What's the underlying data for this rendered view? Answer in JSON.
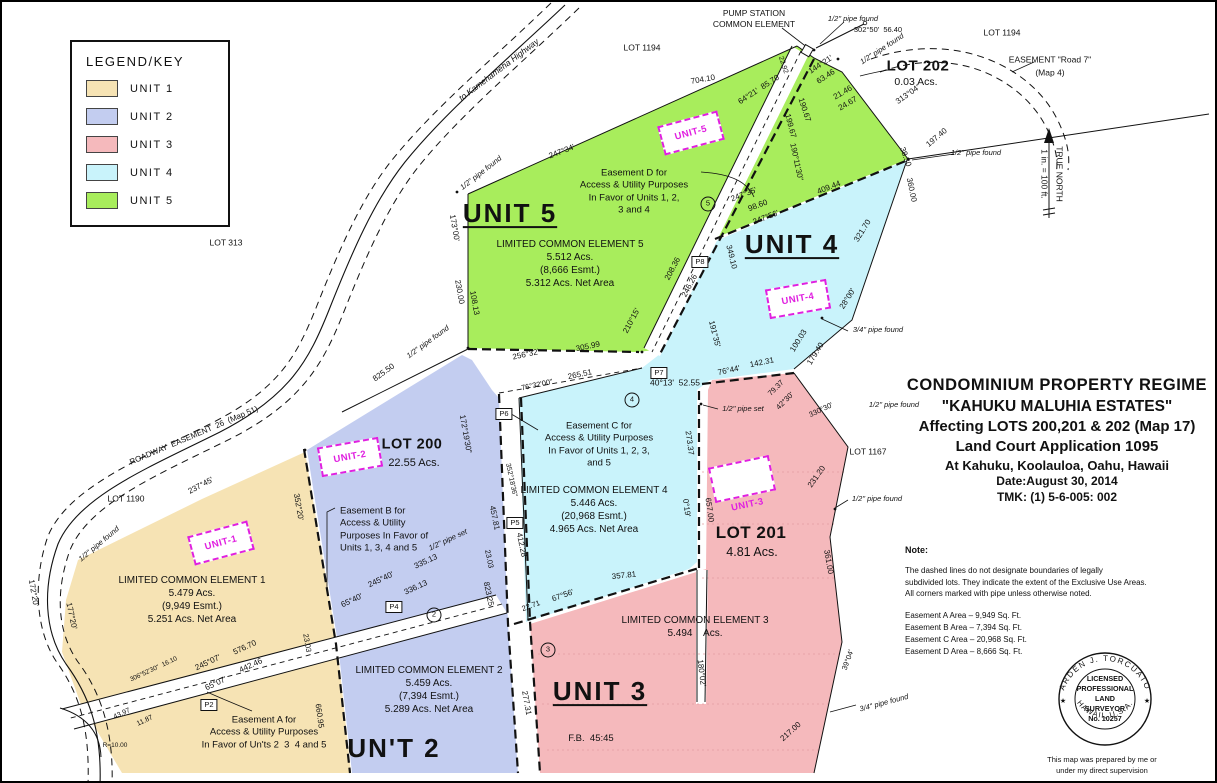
{
  "colors": {
    "unit1": "#F6E3B4",
    "unit2": "#C3CDF0",
    "unit3": "#F5B9BC",
    "unit4": "#C9F3FB",
    "unit5": "#A8ED5C",
    "magenta": "#E020E0",
    "line": "#111111",
    "faint_pink_line": "#E39CA0"
  },
  "legend": {
    "title": "LEGEND/KEY",
    "items": [
      {
        "name": "legend-item-unit1",
        "text": "UNIT 1",
        "color": "#F6E3B4"
      },
      {
        "name": "legend-item-unit2",
        "text": "UNIT 2",
        "color": "#C3CDF0"
      },
      {
        "name": "legend-item-unit3",
        "text": "UNIT 3",
        "color": "#F5B9BC"
      },
      {
        "name": "legend-item-unit4",
        "text": "UNIT 4",
        "color": "#C9F3FB"
      },
      {
        "name": "legend-item-unit5",
        "text": "UNIT 5",
        "color": "#A8ED5C"
      }
    ]
  },
  "title_block": {
    "line1": "CONDOMINIUM  PROPERTY  REGIME",
    "line2": "\"KAHUKU MALUHIA ESTATES\"",
    "line3": "Affecting LOTS 200,201 & 202 (Map 17)",
    "line4": "Land Court Application 1095",
    "line5": "At Kahuku, Koolauloa, Oahu, Hawaii",
    "line6": "Date:August 30, 2014",
    "line7": "TMK: (1) 5-6-005: 002"
  },
  "note": {
    "heading": "Note:",
    "body": "The dashed lines do not designate boundaries of legally\nsubdivided lots. They indicate the extent of the Exclusive Use Areas.\nAll corners marked with pipe unless otherwise noted.",
    "easements": "Easement A Area – 9,949 Sq. Ft.\nEasement B Area – 7,394 Sq. Ft.\nEasement C Area – 20,968 Sq. Ft.\nEasement D Area – 8,666 Sq. Ft."
  },
  "stamp": {
    "arc_top": "ARDEN  J.  TORCUATO",
    "arc_bottom": "HAWAII, U.S.A.",
    "star": "★",
    "lines": [
      {
        "text": "LICENSED"
      },
      {
        "text": "PROFESSIONAL"
      },
      {
        "text": "LAND"
      },
      {
        "text": "SURVEYOR"
      },
      {
        "text": "No. 10257"
      }
    ],
    "caption": "This map was prepared by me or\nunder my direct supervision"
  },
  "unit_markers": [
    {
      "name": "unit-1-marker",
      "text": "UNIT-1",
      "x": 219,
      "y": 541,
      "rot": -15
    },
    {
      "name": "unit-2-marker",
      "text": "UNIT-2",
      "x": 348,
      "y": 455,
      "rot": -10
    },
    {
      "name": "unit-3-marker",
      "text": "UNIT-3",
      "x": 740,
      "y": 477,
      "rot": -12,
      "cls": "below"
    },
    {
      "name": "unit-4-marker",
      "text": "UNIT-4",
      "x": 796,
      "y": 297,
      "rot": -10
    },
    {
      "name": "unit-5-marker",
      "text": "UNIT-5",
      "x": 689,
      "y": 131,
      "rot": -15
    }
  ],
  "point_markers": [
    {
      "name": "point-p2",
      "text": "P2",
      "x": 207,
      "y": 703
    },
    {
      "name": "point-p4",
      "text": "P4",
      "x": 392,
      "y": 605
    },
    {
      "name": "point-p5",
      "text": "P5",
      "x": 513,
      "y": 521
    },
    {
      "name": "point-p6",
      "text": "P6",
      "x": 502,
      "y": 412
    },
    {
      "name": "point-p7",
      "text": "P7",
      "x": 657,
      "y": 371
    },
    {
      "name": "point-p8",
      "text": "P8",
      "x": 698,
      "y": 260
    }
  ],
  "circle_markers": [
    {
      "name": "circle-2",
      "text": "2",
      "x": 432,
      "y": 613
    },
    {
      "name": "circle-3",
      "text": "3",
      "x": 546,
      "y": 648
    },
    {
      "name": "circle-4",
      "text": "4",
      "x": 630,
      "y": 398
    },
    {
      "name": "circle-5",
      "text": "5",
      "x": 706,
      "y": 202
    }
  ],
  "labels": [
    {
      "name": "pump-station-label",
      "text": "PUMP STATION\nCOMMON ELEMENT",
      "x": 752,
      "y": 17,
      "fs": 8.5
    },
    {
      "name": "pipe-found-label",
      "text": "1/2\" pipe found",
      "x": 851,
      "y": 17,
      "fs": 7.5,
      "cls": "it"
    },
    {
      "name": "bearing-label",
      "text": "302°50'  56.40",
      "x": 876,
      "y": 28,
      "fs": 7.5
    },
    {
      "name": "pipe-found-label",
      "text": "1/2\" pipe found",
      "x": 880,
      "y": 47,
      "fs": 7.5,
      "rot": -33,
      "cls": "it"
    },
    {
      "name": "lot-202-label",
      "text": "LOT 202",
      "x": 916,
      "y": 64,
      "fs": 15,
      "cls": "semibold"
    },
    {
      "name": "lot-202-area",
      "text": "0.03 Acs.",
      "x": 914,
      "y": 81,
      "fs": 10.5
    },
    {
      "name": "lot-1194-label",
      "text": "LOT 1194",
      "x": 640,
      "y": 46,
      "fs": 8.5
    },
    {
      "name": "lot-1194-label",
      "text": "LOT 1194",
      "x": 1000,
      "y": 31,
      "fs": 8.5
    },
    {
      "name": "easement-road7-label",
      "text": "EASEMENT \"Road 7\"",
      "x": 1048,
      "y": 58,
      "fs": 8.5
    },
    {
      "name": "easement-road7-map",
      "text": "(Map 4)",
      "x": 1048,
      "y": 71,
      "fs": 8.5
    },
    {
      "name": "meas-label",
      "text": "704.10",
      "x": 701,
      "y": 78,
      "rot": -10
    },
    {
      "name": "meas-label",
      "text": "64°21'  85.70",
      "x": 757,
      "y": 88,
      "rot": -33
    },
    {
      "name": "meas-label",
      "text": "144°21'",
      "x": 819,
      "y": 63,
      "rot": -33
    },
    {
      "name": "meas-label",
      "text": "63.46",
      "x": 824,
      "y": 75,
      "rot": -33
    },
    {
      "name": "meas-label",
      "text": "21.46",
      "x": 841,
      "y": 91,
      "rot": -30
    },
    {
      "name": "meas-label",
      "text": "24.67",
      "x": 846,
      "y": 102,
      "rot": -30
    },
    {
      "name": "meas-label",
      "text": "22.92",
      "x": 781,
      "y": 63,
      "rot": 72,
      "fs": 7
    },
    {
      "name": "meas-label",
      "text": "190.67",
      "x": 802,
      "y": 108,
      "rot": 72
    },
    {
      "name": "meas-label",
      "text": "199.67",
      "x": 788,
      "y": 124,
      "rot": 75
    },
    {
      "name": "meas-label",
      "text": "190°11'30\"",
      "x": 794,
      "y": 160,
      "rot": 78
    },
    {
      "name": "meas-label",
      "text": "313°04'",
      "x": 906,
      "y": 93,
      "rot": -35
    },
    {
      "name": "meas-label",
      "text": "197.40",
      "x": 935,
      "y": 136,
      "rot": -40
    },
    {
      "name": "meas-label",
      "text": "38.30",
      "x": 903,
      "y": 155,
      "rot": 70
    },
    {
      "name": "meas-label",
      "text": "360.00",
      "x": 909,
      "y": 188,
      "rot": 78
    },
    {
      "name": "pipe-found-label",
      "text": "1/2\" pipe found",
      "x": 974,
      "y": 151,
      "fs": 7.5,
      "cls": "it"
    },
    {
      "name": "road-kamehameha-label",
      "text": "to Kamehameha Highway",
      "x": 497,
      "y": 68,
      "fs": 8.5,
      "rot": -37,
      "cls": "it"
    },
    {
      "name": "meas-label",
      "text": "247°34'",
      "x": 560,
      "y": 150,
      "rot": -21
    },
    {
      "name": "pipe-found-label",
      "text": "1/2\" pipe found",
      "x": 479,
      "y": 171,
      "fs": 7.5,
      "rot": -38,
      "cls": "it"
    },
    {
      "name": "meas-label",
      "text": "173°00'",
      "x": 452,
      "y": 226,
      "rot": 80
    },
    {
      "name": "meas-label",
      "text": "230.00",
      "x": 457,
      "y": 290,
      "rot": 80
    },
    {
      "name": "meas-label",
      "text": "108.13",
      "x": 472,
      "y": 301,
      "rot": 80
    },
    {
      "name": "lot-313-label",
      "text": "LOT 313",
      "x": 224,
      "y": 241,
      "fs": 8.5
    },
    {
      "name": "unit5-title",
      "text": "UNIT 5",
      "x": 508,
      "y": 212,
      "fs": 26,
      "cls": "big underline"
    },
    {
      "name": "easement-d-note",
      "text": "Easement D for\nAccess & Utility Purposes\nIn Favor of Units 1, 2,\n3 and 4",
      "x": 632,
      "y": 190,
      "fs": 9.5
    },
    {
      "name": "lce5-note",
      "text": "LIMITED COMMON ELEMENT 5\n5.512 Acs.\n(8,666 Esmt.)\n5.312 Acs. Net Area",
      "x": 568,
      "y": 262,
      "fs": 10,
      "cls": "lce"
    },
    {
      "name": "meas-label",
      "text": "256°32'",
      "x": 524,
      "y": 353,
      "rot": -12
    },
    {
      "name": "meas-label",
      "text": "305.99",
      "x": 586,
      "y": 345,
      "rot": -12
    },
    {
      "name": "meas-label",
      "text": "76°32'00\"",
      "x": 535,
      "y": 383,
      "fs": 7.5,
      "rot": -12
    },
    {
      "name": "meas-label",
      "text": "265.51",
      "x": 578,
      "y": 373,
      "rot": -12
    },
    {
      "name": "meas-label",
      "text": "825.50",
      "x": 382,
      "y": 371,
      "rot": -36
    },
    {
      "name": "pipe-found-label",
      "text": "1/2\" pipe found",
      "x": 426,
      "y": 340,
      "fs": 7.5,
      "rot": -36,
      "cls": "it"
    },
    {
      "name": "meas-label",
      "text": "210°15'",
      "x": 630,
      "y": 319,
      "rot": -62
    },
    {
      "name": "meas-label",
      "text": "208.36",
      "x": 671,
      "y": 267,
      "rot": -62
    },
    {
      "name": "meas-label",
      "text": "246.26",
      "x": 688,
      "y": 284,
      "rot": -62
    },
    {
      "name": "meas-label",
      "text": "247°35'",
      "x": 742,
      "y": 193,
      "rot": -21
    },
    {
      "name": "meas-label",
      "text": "98.60",
      "x": 756,
      "y": 204,
      "rot": -21
    },
    {
      "name": "meas-label",
      "text": "247°56'",
      "x": 764,
      "y": 216,
      "rot": -21
    },
    {
      "name": "meas-label",
      "text": "409.44",
      "x": 827,
      "y": 186,
      "rot": -21
    },
    {
      "name": "meas-label",
      "text": "349.10",
      "x": 729,
      "y": 255,
      "rot": 76
    },
    {
      "name": "meas-label",
      "text": "321.70",
      "x": 861,
      "y": 229,
      "rot": -58
    },
    {
      "name": "unit4-title",
      "text": "UNIT 4",
      "x": 790,
      "y": 243,
      "fs": 26,
      "cls": "big underline"
    },
    {
      "name": "meas-label",
      "text": "28°00'",
      "x": 846,
      "y": 297,
      "rot": -58
    },
    {
      "name": "meas-label",
      "text": "191°35'",
      "x": 712,
      "y": 332,
      "rot": 76
    },
    {
      "name": "meas-label",
      "text": "100.03",
      "x": 797,
      "y": 339,
      "rot": -58
    },
    {
      "name": "meas-label",
      "text": "179.40",
      "x": 814,
      "y": 352,
      "rot": -58
    },
    {
      "name": "pipe-found-label",
      "text": "3/4\" pipe found",
      "x": 876,
      "y": 328,
      "fs": 7.5,
      "cls": "it"
    },
    {
      "name": "meas-label",
      "text": "142.31",
      "x": 760,
      "y": 361,
      "rot": -12
    },
    {
      "name": "meas-label",
      "text": "76°44'",
      "x": 727,
      "y": 369,
      "rot": -12
    },
    {
      "name": "meas-label",
      "text": "40°13'  52.55",
      "x": 673,
      "y": 381,
      "fs": 8.5
    },
    {
      "name": "meas-label",
      "text": "79.37",
      "x": 774,
      "y": 386,
      "fs": 7.5,
      "rot": -45
    },
    {
      "name": "meas-label",
      "text": "42°30'",
      "x": 783,
      "y": 399,
      "fs": 7.5,
      "rot": -45
    },
    {
      "name": "meas-label",
      "text": "330°30'",
      "x": 819,
      "y": 408,
      "fs": 7.5,
      "rot": -25
    },
    {
      "name": "pipe-set-label",
      "text": "1/2\" pipe set",
      "x": 741,
      "y": 407,
      "fs": 7.5,
      "cls": "it"
    },
    {
      "name": "pipe-found-label",
      "text": "1/2\" pipe found",
      "x": 892,
      "y": 403,
      "fs": 7.5,
      "cls": "it"
    },
    {
      "name": "easement-c-note",
      "text": "Easement C for\nAccess & Utility Purposes\nIn Favor of Units 1, 2, 3,\nand 5",
      "x": 597,
      "y": 443,
      "fs": 9.5
    },
    {
      "name": "lce4-note",
      "text": "LIMITED COMMON ELEMENT 4\n5.446 Acs.\n(20,968 Esmt.)\n4.965 Acs. Net Area",
      "x": 592,
      "y": 508,
      "fs": 10,
      "cls": "lce"
    },
    {
      "name": "meas-label",
      "text": "273.37",
      "x": 687,
      "y": 441,
      "rot": 82
    },
    {
      "name": "meas-label",
      "text": "0°19'",
      "x": 684,
      "y": 506,
      "rot": 82
    },
    {
      "name": "meas-label",
      "text": "657.00",
      "x": 707,
      "y": 508,
      "rot": 82
    },
    {
      "name": "meas-label",
      "text": "357.81",
      "x": 622,
      "y": 574,
      "rot": -6
    },
    {
      "name": "meas-label",
      "text": "67°56'",
      "x": 561,
      "y": 594,
      "rot": -20
    },
    {
      "name": "meas-label",
      "text": "22.71",
      "x": 529,
      "y": 604,
      "fs": 7.5,
      "rot": -20
    },
    {
      "name": "meas-label",
      "text": "823.25",
      "x": 486,
      "y": 592,
      "rot": 78
    },
    {
      "name": "meas-label",
      "text": "457.81",
      "x": 492,
      "y": 516,
      "rot": 78
    },
    {
      "name": "meas-label",
      "text": "412.28",
      "x": 519,
      "y": 543,
      "rot": 78
    },
    {
      "name": "meas-label",
      "text": "352°18'36\"",
      "x": 509,
      "y": 478,
      "fs": 7,
      "rot": 78
    },
    {
      "name": "meas-label",
      "text": "172°19'30\"",
      "x": 463,
      "y": 432,
      "rot": 80
    },
    {
      "name": "lot-200-label",
      "text": "LOT 200",
      "x": 410,
      "y": 443,
      "fs": 14.5,
      "cls": "semibold"
    },
    {
      "name": "lot-200-area",
      "text": "22.55 Acs.",
      "x": 412,
      "y": 461,
      "fs": 11
    },
    {
      "name": "easement-b-note",
      "text": "Easement B for\nAccess & Utility\nPurposes In Favor of\nUnits 1, 3, 4 and 5",
      "x": 338,
      "y": 528,
      "fs": 9.5,
      "anchor": "w"
    },
    {
      "name": "meas-label",
      "text": "245°40'",
      "x": 379,
      "y": 578,
      "rot": -25
    },
    {
      "name": "meas-label",
      "text": "335.13",
      "x": 424,
      "y": 560,
      "rot": -25
    },
    {
      "name": "meas-label",
      "text": "65°40'",
      "x": 350,
      "y": 599,
      "rot": -25
    },
    {
      "name": "meas-label",
      "text": "336.13",
      "x": 414,
      "y": 586,
      "rot": -25
    },
    {
      "name": "pipe-set-label",
      "text": "1/2\" pipe set",
      "x": 446,
      "y": 538,
      "fs": 7.5,
      "rot": -25,
      "cls": "it"
    },
    {
      "name": "meas-label",
      "text": "23.03",
      "x": 487,
      "y": 557,
      "fs": 7.5,
      "rot": 78
    },
    {
      "name": "lce2-note",
      "text": "LIMITED COMMON ELEMENT 2\n5.459 Acs.\n(7,394 Esmt.)\n5.289 Acs. Net Area",
      "x": 427,
      "y": 688,
      "fs": 10,
      "cls": "lce"
    },
    {
      "name": "unit2-title",
      "text": "UN'T 2",
      "x": 392,
      "y": 747,
      "fs": 26,
      "cls": "big"
    },
    {
      "name": "meas-label",
      "text": "277.31",
      "x": 524,
      "y": 701,
      "rot": 80
    },
    {
      "name": "lce3-note",
      "text": "LIMITED COMMON ELEMENT 3\n5.494    Acs.",
      "x": 693,
      "y": 625,
      "fs": 10,
      "cls": "lce"
    },
    {
      "name": "unit3-title",
      "text": "UNIT 3",
      "x": 598,
      "y": 690,
      "fs": 26,
      "cls": "big underline"
    },
    {
      "name": "field-book-label",
      "text": "F.B.  45:45",
      "x": 589,
      "y": 737,
      "fs": 9.5
    },
    {
      "name": "meas-label",
      "text": "180°02'",
      "x": 699,
      "y": 671,
      "rot": 83
    },
    {
      "name": "meas-label",
      "text": "217.00",
      "x": 789,
      "y": 730,
      "rot": -42
    },
    {
      "name": "meas-label",
      "text": "39°04'",
      "x": 846,
      "y": 658,
      "fs": 7.5,
      "rot": -70
    },
    {
      "name": "meas-label",
      "text": "231.20",
      "x": 815,
      "y": 475,
      "rot": -55
    },
    {
      "name": "lot-201-label",
      "text": "LOT 201",
      "x": 749,
      "y": 531,
      "fs": 17,
      "cls": "semibold"
    },
    {
      "name": "lot-201-area",
      "text": "4.81 Acs.",
      "x": 750,
      "y": 550,
      "fs": 12.5
    },
    {
      "name": "lot-1167-label",
      "text": "LOT 1167",
      "x": 866,
      "y": 450,
      "fs": 8.5
    },
    {
      "name": "pipe-found-label",
      "text": "1/2\" pipe found",
      "x": 875,
      "y": 497,
      "fs": 7.5,
      "cls": "it"
    },
    {
      "name": "meas-label",
      "text": "361.00",
      "x": 826,
      "y": 560,
      "rot": 80
    },
    {
      "name": "pipe-found-label",
      "text": "3/4\" pipe found",
      "x": 882,
      "y": 701,
      "fs": 7.5,
      "rot": -15,
      "cls": "it"
    },
    {
      "name": "lot-1190-label",
      "text": "LOT 1190",
      "x": 124,
      "y": 497,
      "fs": 8.5
    },
    {
      "name": "meas-label",
      "text": "237°45'",
      "x": 199,
      "y": 484,
      "rot": -28
    },
    {
      "name": "roadway-easement-label",
      "text": "ROADWAY  EASEMENT  26  (Map 51)",
      "x": 192,
      "y": 434,
      "fs": 8,
      "rot": -23
    },
    {
      "name": "lce1-note",
      "text": "LIMITED COMMON ELEMENT 1\n5.479 Acs.\n(9,949 Esmt.)\n5.251 Acs. Net Area",
      "x": 190,
      "y": 598,
      "fs": 10,
      "cls": "lce"
    },
    {
      "name": "pipe-found-label",
      "text": "1/2\" pipe found",
      "x": 97,
      "y": 542,
      "fs": 7.5,
      "rot": -40,
      "cls": "it"
    },
    {
      "name": "meas-label",
      "text": "177°20'",
      "x": 69,
      "y": 614,
      "rot": 78
    },
    {
      "name": "meas-label",
      "text": "172°20'",
      "x": 31,
      "y": 591,
      "rot": 80
    },
    {
      "name": "meas-label",
      "text": "352°20'",
      "x": 296,
      "y": 505,
      "rot": 80
    },
    {
      "name": "meas-label",
      "text": "23.03",
      "x": 305,
      "y": 641,
      "fs": 7.5,
      "rot": 80
    },
    {
      "name": "meas-label",
      "text": "245°07'",
      "x": 206,
      "y": 661,
      "rot": -25
    },
    {
      "name": "meas-label",
      "text": "576.70",
      "x": 243,
      "y": 646,
      "rot": -25
    },
    {
      "name": "meas-label",
      "text": "442.46",
      "x": 249,
      "y": 664,
      "rot": -25
    },
    {
      "name": "meas-label",
      "text": "65°07'",
      "x": 214,
      "y": 682,
      "rot": -25
    },
    {
      "name": "easement-a-note",
      "text": "Easement A for\nAccess & Utility Purposes\nIn Favor of Un'ts 2  3  4 and 5",
      "x": 262,
      "y": 731,
      "fs": 9.5
    },
    {
      "name": "meas-label",
      "text": "660.95",
      "x": 317,
      "y": 714,
      "rot": 82
    },
    {
      "name": "meas-label",
      "text": "306°52'30\"  16.10",
      "x": 152,
      "y": 668,
      "fs": 6.5,
      "rot": -25
    },
    {
      "name": "meas-label",
      "text": "43.97",
      "x": 120,
      "y": 712,
      "fs": 7,
      "rot": -25
    },
    {
      "name": "meas-label",
      "text": "11.87",
      "x": 143,
      "y": 719,
      "fs": 7,
      "rot": -25
    },
    {
      "name": "meas-label",
      "text": "R=10.00",
      "x": 113,
      "y": 744,
      "fs": 6.5
    },
    {
      "name": "true-north-label",
      "text": "TRUE NORTH",
      "x": 1057,
      "y": 172,
      "rot": 90,
      "fs": 8.5
    },
    {
      "name": "scale-label",
      "text": "1 in. = 100 ft.",
      "x": 1042,
      "y": 172,
      "rot": 90,
      "fs": 8.5
    }
  ]
}
